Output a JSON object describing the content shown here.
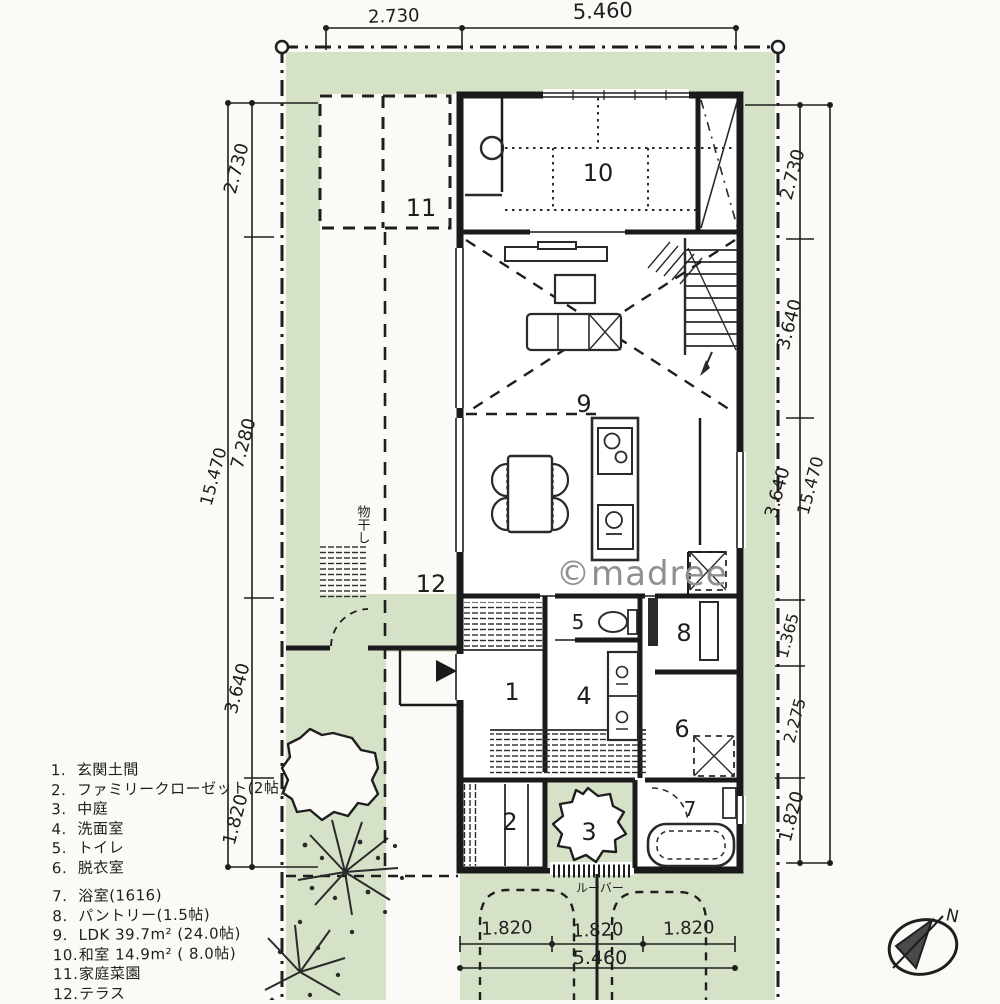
{
  "colors": {
    "garden_green": "#d6e2c8",
    "ink": "#222222",
    "paper": "#fbfaf7",
    "watermark_gray": "#8f8f8f"
  },
  "watermark": {
    "text": "©madree"
  },
  "compass": {
    "label": "N"
  },
  "plan": {
    "room_numbers": {
      "r1": "1",
      "r2": "2",
      "r3": "3",
      "r4": "4",
      "r5": "5",
      "r6": "6",
      "r7": "7",
      "r8": "8",
      "r9": "9",
      "r10": "10",
      "r11": "11",
      "r12": "12"
    },
    "annotations": {
      "louver": "ルーバー",
      "laundry": "物干し"
    }
  },
  "dimensions": {
    "top": {
      "segments": [
        "2.730",
        "5.460"
      ]
    },
    "left": {
      "segments": [
        "2.730",
        "7.280",
        "3.640",
        "1.820"
      ],
      "total": "15.470"
    },
    "right": {
      "segments": [
        "2.730",
        "3.640",
        "3.640",
        "1.365",
        "2.275",
        "1.820"
      ],
      "total": "15.470"
    },
    "bottom": {
      "segments": [
        "1.820",
        "1.820",
        "1.820"
      ],
      "total": "5.460"
    }
  },
  "legend": {
    "items": [
      {
        "num": "1.",
        "label": "玄関土間"
      },
      {
        "num": "2.",
        "label": "ファミリークローゼット(2帖)"
      },
      {
        "num": "3.",
        "label": "中庭"
      },
      {
        "num": "4.",
        "label": "洗面室"
      },
      {
        "num": "5.",
        "label": "トイレ"
      },
      {
        "num": "6.",
        "label": "脱衣室"
      },
      {
        "num": "7.",
        "label": "浴室(1616)"
      },
      {
        "num": "8.",
        "label": "パントリー(1.5帖)"
      },
      {
        "num": "9.",
        "label": "LDK 39.7m² (24.0帖)"
      },
      {
        "num": "10.",
        "label": "和室 14.9m² ( 8.0帖)"
      },
      {
        "num": "11.",
        "label": "家庭菜園"
      },
      {
        "num": "12.",
        "label": "テラス"
      }
    ]
  }
}
